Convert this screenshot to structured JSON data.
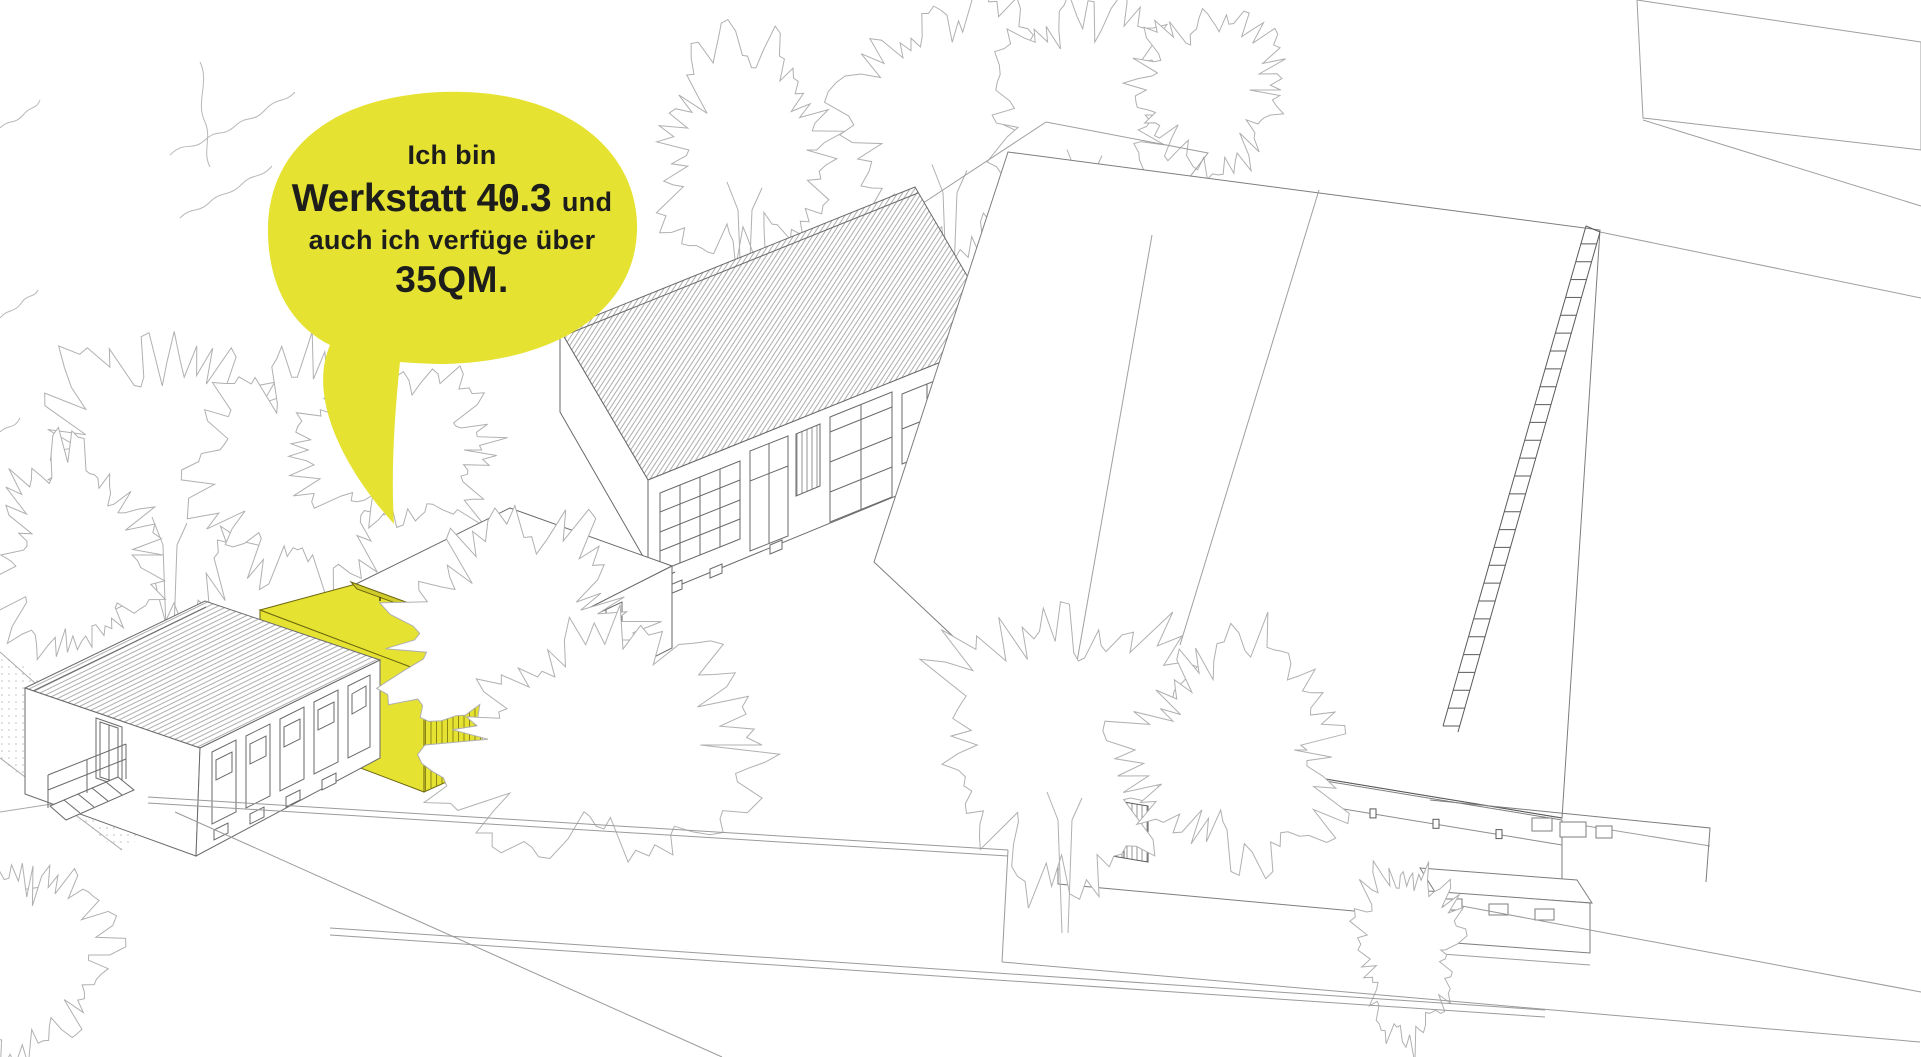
{
  "bubble": {
    "line1": "Ich bin",
    "line2_pre": "Werkstatt 4",
    "line2_zero": "0",
    "line2_post": ".3",
    "line2_suffix": "und",
    "line3": "auch ich verfüge über",
    "line4": "35QM."
  },
  "colors": {
    "bubble_yellow": "#e5e232",
    "highlight_yellow": "#e5e232",
    "highlight_beam": "#cfcb2b",
    "highlight_outline": "#6b660e",
    "slat_yellow": "#8b8616",
    "ink": "#1d1d1b",
    "line_light": "#b3b3b3",
    "line_mid": "#8c8c8c",
    "line_dark": "#5a5a5a"
  }
}
